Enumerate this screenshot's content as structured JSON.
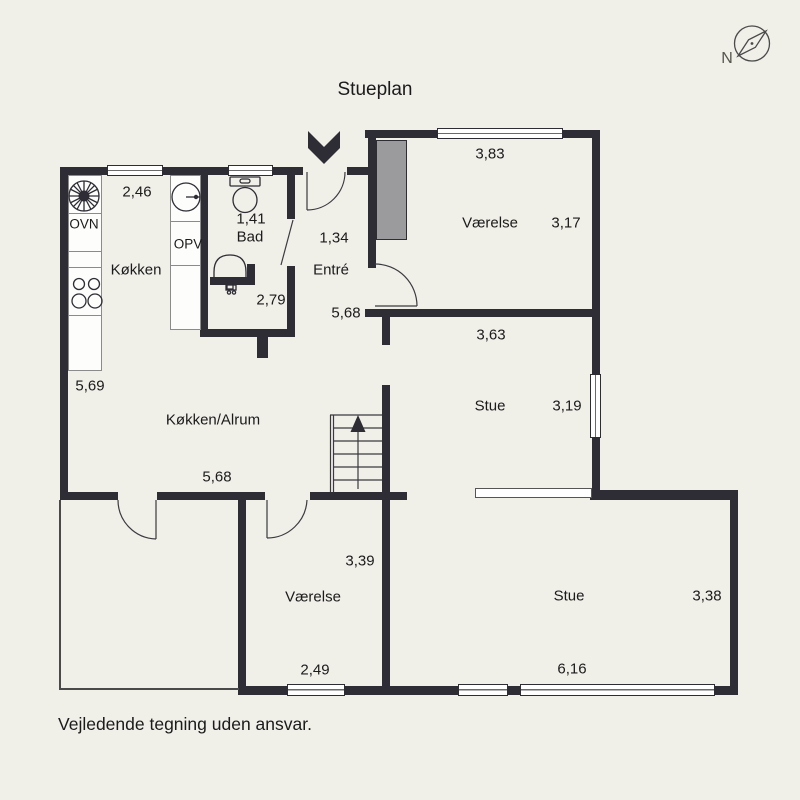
{
  "title": "Stueplan",
  "footer": "Vejledende tegning uden ansvar.",
  "compass_label": "N",
  "colors": {
    "background": "#f0efe8",
    "wall": "#2e2c34",
    "closet_gray": "#9b9a9c",
    "line": "#3b3a40",
    "text": "#1b1b1b"
  },
  "appliances": {
    "oven_label": "OVN",
    "dishwasher_label": "OPV"
  },
  "rooms": {
    "koekken": {
      "label": "Køkken",
      "dim_width": "2,46"
    },
    "bad": {
      "label": "Bad",
      "dim_width": "1,41",
      "dim_depth": "2,79"
    },
    "entre": {
      "label": "Entré",
      "dim_width": "1,34",
      "dim_depth": "5,68"
    },
    "vaerelse_top": {
      "label": "Værelse",
      "dim_width": "3,83",
      "dim_depth": "3,17"
    },
    "stue_mid": {
      "label": "Stue",
      "dim_width": "3,63",
      "dim_depth": "3,19"
    },
    "koekken_alrum": {
      "label": "Køkken/Alrum",
      "dim_height": "5,69",
      "dim_width": "5,68"
    },
    "vaerelse_low": {
      "label": "Værelse",
      "dim_height": "3,39",
      "dim_width": "2,49"
    },
    "stue_low": {
      "label": "Stue",
      "dim_height": "3,38",
      "dim_width": "6,16"
    }
  }
}
